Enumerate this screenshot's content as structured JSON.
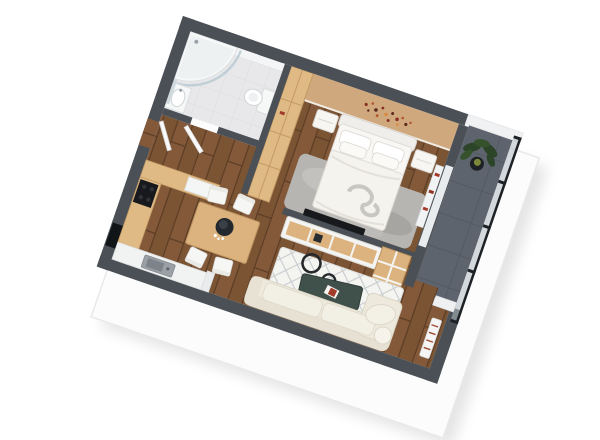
{
  "image": {
    "type": "isometric-3d-floorplan-render",
    "description": "3D rendered floor plan of a one-bedroom apartment with bathroom, bedroom, kitchen-living room and balcony",
    "background": "#ffffff"
  },
  "palette": {
    "wall_dark": "#4a5056",
    "wall_white": "#f0f1f2",
    "plinth": "#fcfcfc",
    "plinth_edge": "#e9e9e9",
    "floor_wood": "#7b5434",
    "wood_seam": "#5c3d24",
    "floor_bath": "#e8e8ea",
    "floor_balcony": "#5d646d",
    "wall_tan": "#cfa87d",
    "cabinet_wood": "#e0ba85",
    "table_wood": "#dcb37e",
    "furniture_white": "#f8f7f4",
    "sofa_cream": "#eee9dd",
    "rug_gray": "#b7b5b2",
    "rug_white": "#f4f4f1",
    "rug_lattice": "#c6cacd",
    "coffee_table_dark": "#40504a",
    "appliance_black": "#17191c",
    "plant_green": "#2c4427",
    "accent_red": "#a33b2a",
    "glass": "#aeb9c0",
    "railing_black": "#1d2125"
  },
  "rooms": [
    {
      "name": "bathroom",
      "items": [
        "corner bathtub with curved glass shower screen",
        "sink vanity",
        "mirror",
        "toilet",
        "wall niche"
      ]
    },
    {
      "name": "bedroom",
      "items": [
        "double bed with pillows",
        "headboard",
        "two nightstands",
        "wardrobe",
        "gray rug",
        "wall art",
        "wall shelf with red books",
        "tv"
      ]
    },
    {
      "name": "kitchen-dining",
      "items": [
        "l-shaped counter",
        "cooktop",
        "fridge",
        "sink",
        "dining table",
        "four chairs",
        "dark centerpiece"
      ]
    },
    {
      "name": "living-room",
      "items": [
        "cream corner sofa",
        "dark coffee table",
        "white diamond rug",
        "pendant light rings",
        "media console",
        "bookshelf",
        "radiator"
      ]
    },
    {
      "name": "balcony",
      "items": [
        "potted plant",
        "glass railing with black frame",
        "tiled floor"
      ]
    }
  ]
}
